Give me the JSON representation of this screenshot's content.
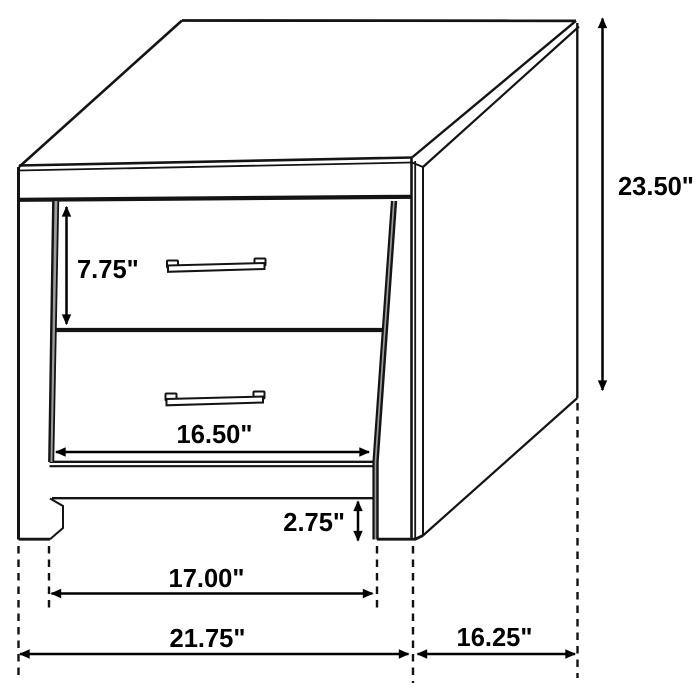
{
  "diagram": {
    "kind": "furniture-dimension-drawing",
    "subject": "two-drawer nightstand line drawing with dimension arrows",
    "colors": {
      "line": "#141414",
      "background": "#ffffff",
      "reveal_shade": "#9d9d9d"
    },
    "dimensions": {
      "overall_height": "23.50\"",
      "drawer_front_height": "7.75\"",
      "drawer_width": "16.50\"",
      "foot_clearance": "2.75\"",
      "between_legs_width": "17.00\"",
      "overall_width": "21.75\"",
      "side_depth": "16.25\""
    }
  }
}
